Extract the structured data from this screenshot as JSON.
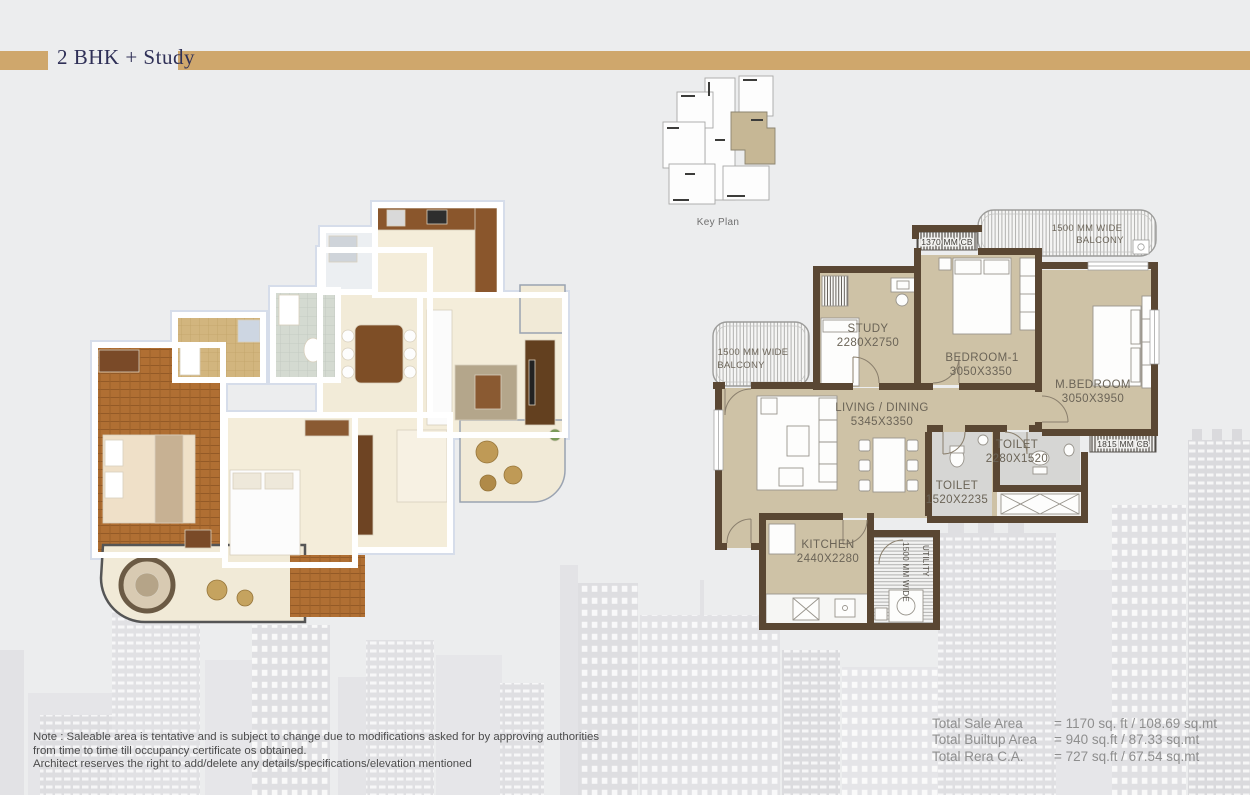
{
  "header": {
    "title": "2 BHK + Study"
  },
  "key_plan": {
    "label": "Key Plan"
  },
  "plan": {
    "balcony_top_l1": "1500 MM WIDE",
    "balcony_top_l2": "BALCONY",
    "cb_top": "1370 MM CB",
    "study_name": "STUDY",
    "study_dim": "2280X2750",
    "bedroom1_name": "BEDROOM-1",
    "bedroom1_dim": "3050X3350",
    "mbedroom_name": "M.BEDROOM",
    "mbedroom_dim": "3050X3950",
    "balcony_left_l1": "1500 MM WIDE",
    "balcony_left_l2": "BALCONY",
    "living_name": "LIVING / DINING",
    "living_dim": "5345X3350",
    "toilet_right_name": "TOILET",
    "toilet_right_dim": "2280X1520",
    "toilet_left_name": "TOILET",
    "toilet_left_dim": "1520X2235",
    "cb_right": "1815 MM CB",
    "kitchen_name": "KITCHEN",
    "kitchen_dim": "2440X2280",
    "utility_l1": "UTILITY",
    "utility_l2": "1500 MM WIDE"
  },
  "note": {
    "line1": "Note : Saleable area is tentative and is subject to change due to modifications asked for by approving authorities",
    "line2": "from time to time till occupancy certificate os obtained.",
    "line3": "Architect reserves the right to add/delete any details/specifications/elevation mentioned"
  },
  "totals": {
    "rows": [
      {
        "label": "Total Sale Area",
        "value": "= 1170 sq. ft / 108.69 sq.mt"
      },
      {
        "label": "Total Builtup Area",
        "value": "= 940 sq.ft / 87.33 sq.mt"
      },
      {
        "label": "Total Rera C.A.",
        "value": "= 727 sq.ft / 67.54 sq.mt"
      }
    ]
  },
  "colors": {
    "accent_gold": "#cfa76c",
    "title_navy": "#2f3057",
    "wall_brown": "#5a4733",
    "floor_beige": "#cec2a6",
    "toilet_gray": "#d6d6d4",
    "keyplan_highlight": "#c6b795",
    "background": "#ecedee",
    "note_text": "#4b4b4b",
    "totals_text": "#8e8e8e"
  }
}
